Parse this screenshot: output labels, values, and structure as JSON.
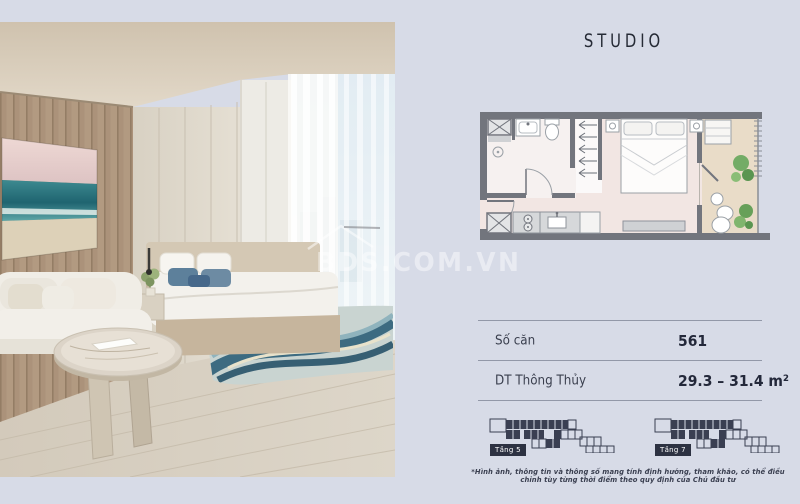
{
  "watermark": {
    "text": "BDS.COM.VN"
  },
  "panel": {
    "title": "STUDIO",
    "unit_table": {
      "rows": [
        {
          "label": "Số căn",
          "value": "561"
        },
        {
          "label": "DT Thông Thủy",
          "value": "29.3 – 31.4 m²"
        }
      ]
    },
    "key_plans": [
      {
        "label": "Tầng 5"
      },
      {
        "label": "Tầng 7"
      }
    ],
    "disclaimer": "*Hình ảnh, thông tin và thông số mang tính định hướng, tham khảo, có thể điều chỉnh tùy từng thời điểm theo quy định của Chủ đầu tư"
  },
  "colors": {
    "background": "#d7dbe7",
    "text_primary": "#262b38",
    "plan_wall": "#72757d",
    "plan_room_floor": "#f2e6e3",
    "plan_balcony_floor": "#e9dcc8",
    "plan_plant_green": "#5f9e54",
    "rug_blue": "#2e5f78",
    "badge_dark": "#2d3242"
  }
}
